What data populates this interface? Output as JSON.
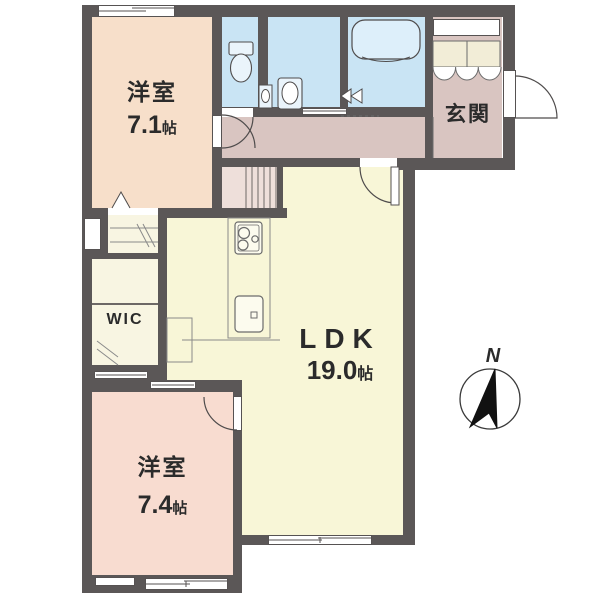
{
  "plan": {
    "type": "apartment-floor-plan"
  },
  "rooms": {
    "bedroom_top": {
      "name": "洋室",
      "area": "7.1",
      "unit": "帖"
    },
    "bedroom_bottom": {
      "name": "洋室",
      "area": "7.4",
      "unit": "帖"
    },
    "ldk": {
      "name": "LDK",
      "area": "19.0",
      "unit": "帖"
    },
    "entrance": {
      "name": "玄関"
    },
    "wic": {
      "name": "WIC"
    }
  },
  "compass": {
    "north_label": "N"
  },
  "icons": {
    "compass": "compass-rose-north-arrow",
    "toilet": "toilet-bowl",
    "bathtub": "bathtub",
    "washbasin": "vanity-sink",
    "stove": "3-burner-stove",
    "kitchen_sink": "kitchen-sink"
  },
  "colors": {
    "background": "#ffffff",
    "wall": "#5b5757",
    "bedroom_top_floor": "#f7dfca",
    "bedroom_bottom_floor": "#f8dcd0",
    "hall_floor": "#d9c5c1",
    "wet_floor": "#c9e4f4",
    "ldk_floor": "#f8f6d7",
    "closet_floor": "#f8f5e2",
    "cabinet_fill": "#f2edd7",
    "stair_cell": "#eedfda",
    "fixture_fill": "#eaf4fb",
    "outline": "#4f4c4c"
  }
}
